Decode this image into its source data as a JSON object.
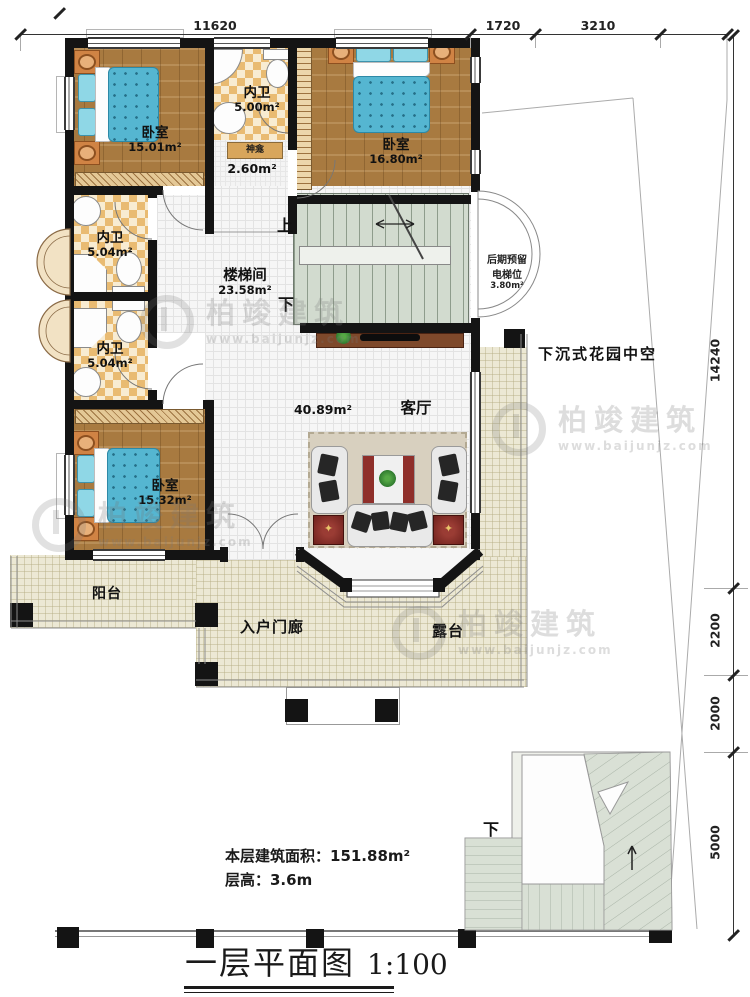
{
  "palette": {
    "wall": "#141414",
    "wood_floor": "#a87a40",
    "checker_tile": "#e9bb72",
    "bed_blue": "#55b6d1",
    "stair_green": "#d2dbcf",
    "terrace_cream": "#ece8d4",
    "accent_red_table": "#6e211d",
    "watermark_gray": "#787878"
  },
  "dimensions": {
    "top": [
      "11620",
      "1720",
      "3210"
    ],
    "right": [
      "14240",
      "2200",
      "2000",
      "5000"
    ]
  },
  "rooms": {
    "bedroom_top_left": {
      "label": "卧室",
      "area": "15.01m²"
    },
    "bath_top": {
      "label": "内卫",
      "area": "5.00m²"
    },
    "shrine": {
      "label": "神龛",
      "area": "2.60m²"
    },
    "bedroom_top_right": {
      "label": "卧室",
      "area": "16.80m²"
    },
    "stair_hall": {
      "label": "楼梯间",
      "area": "23.58m²"
    },
    "bath_left_upper": {
      "label": "内卫",
      "area": "5.04m²"
    },
    "bath_left_lower": {
      "label": "内卫",
      "area": "5.04m²"
    },
    "bedroom_bottom_left": {
      "label": "卧室",
      "area": "15.32m²"
    },
    "living": {
      "label": "客厅",
      "area": "40.89m²"
    },
    "elevator": {
      "line1": "后期预留",
      "line2": "电梯位",
      "area": "3.80m²"
    },
    "garden": {
      "label": "下沉式花园中空"
    },
    "balcony": {
      "label": "阳台"
    },
    "porch": {
      "label": "入户门廊"
    },
    "terrace": {
      "label": "露台"
    }
  },
  "stairs": {
    "up": "上",
    "down": "下",
    "outdoor_down": "下"
  },
  "notes": {
    "floor_area": "本层建筑面积：151.88m²",
    "floor_height": "层高：3.6m"
  },
  "title": {
    "name": "一层平面图",
    "scale": "1:100"
  },
  "watermark": {
    "name": "柏竣建筑",
    "url": "www.baijunjz.com"
  }
}
